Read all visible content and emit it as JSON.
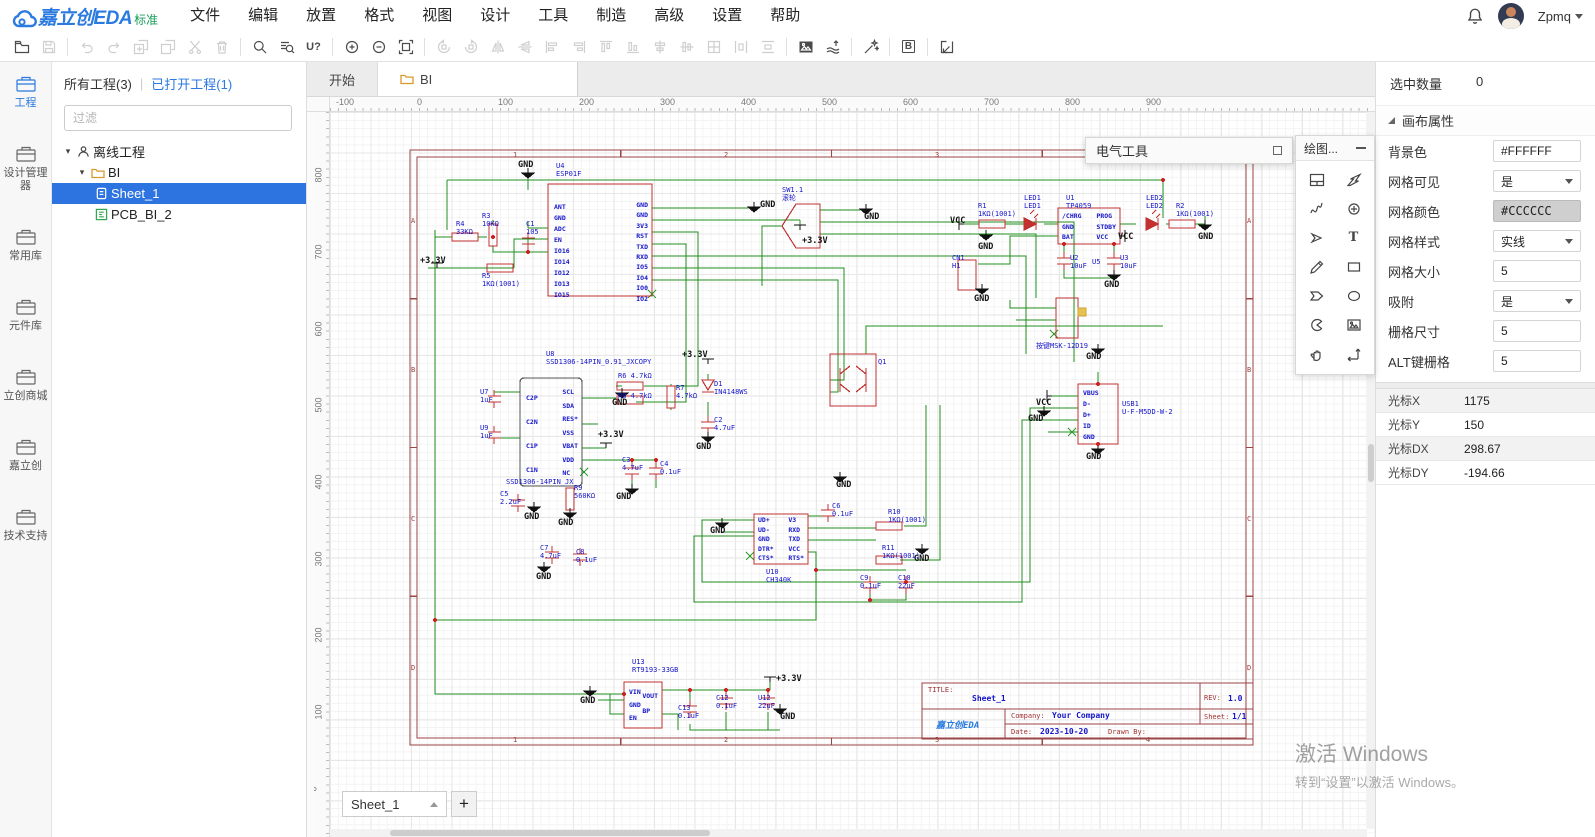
{
  "app": {
    "logo_text": "嘉立创EDA",
    "logo_badge": "标准",
    "user": "Zpmq"
  },
  "menubar": {
    "items": [
      "文件",
      "编辑",
      "放置",
      "格式",
      "视图",
      "设计",
      "工具",
      "制造",
      "高级",
      "设置",
      "帮助"
    ]
  },
  "toolbar": {
    "find_designator": "U?",
    "bom_letter": "B"
  },
  "rail": {
    "items": [
      {
        "label": "工程",
        "active": true
      },
      {
        "label": "设计管理器"
      },
      {
        "label": "常用库"
      },
      {
        "label": "元件库"
      },
      {
        "label": "立创商城"
      },
      {
        "label": "嘉立创"
      },
      {
        "label": "技术支持"
      }
    ]
  },
  "project_panel": {
    "tab_all": "所有工程(3)",
    "tab_divider": "|",
    "tab_open": "已打开工程(1)",
    "filter_placeholder": "过滤",
    "tree": {
      "root": "离线工程",
      "project": "BI",
      "sheet": "Sheet_1",
      "pcb": "PCB_BI_2"
    }
  },
  "doc_tabs": [
    {
      "label": "开始"
    },
    {
      "label": "BI",
      "active": true
    }
  ],
  "rulers": {
    "h": [
      {
        "t": "-100",
        "x": 6
      },
      {
        "t": "0",
        "x": 87
      },
      {
        "t": "100",
        "x": 168
      },
      {
        "t": "200",
        "x": 249
      },
      {
        "t": "300",
        "x": 330
      },
      {
        "t": "400",
        "x": 411
      },
      {
        "t": "500",
        "x": 492
      },
      {
        "t": "600",
        "x": 573
      },
      {
        "t": "700",
        "x": 654
      },
      {
        "t": "800",
        "x": 735
      },
      {
        "t": "900",
        "x": 816
      }
    ],
    "v": [
      {
        "t": "800",
        "y": 58
      },
      {
        "t": "700",
        "y": 135
      },
      {
        "t": "600",
        "y": 212
      },
      {
        "t": "500",
        "y": 288
      },
      {
        "t": "400",
        "y": 365
      },
      {
        "t": "300",
        "y": 442
      },
      {
        "t": "200",
        "y": 518
      },
      {
        "t": "100",
        "y": 595
      },
      {
        "t": "0",
        "y": 672
      }
    ]
  },
  "panels": {
    "electrical_title": "电气工具",
    "drawing_title": "绘图...",
    "drawing_text_tool": "T"
  },
  "sheet_bar": {
    "current": "Sheet_1",
    "add": "+"
  },
  "properties": {
    "selected_count_label": "选中数量",
    "selected_count": "0",
    "section_title": "画布属性",
    "rows": [
      {
        "label": "背景色",
        "value": "#FFFFFF",
        "type": "input"
      },
      {
        "label": "网格可见",
        "value": "是",
        "type": "select"
      },
      {
        "label": "网格颜色",
        "value": "#CCCCCC",
        "type": "color"
      },
      {
        "label": "网格样式",
        "value": "实线",
        "type": "select"
      },
      {
        "label": "网格大小",
        "value": "5",
        "type": "input"
      },
      {
        "label": "吸附",
        "value": "是",
        "type": "select"
      },
      {
        "label": "栅格尺寸",
        "value": "5",
        "type": "input"
      },
      {
        "label": "ALT键栅格",
        "value": "5",
        "type": "input"
      }
    ],
    "cursor_rows": [
      {
        "label": "光标X",
        "value": "1175"
      },
      {
        "label": "光标Y",
        "value": "150"
      },
      {
        "label": "光标DX",
        "value": "298.67"
      },
      {
        "label": "光标DY",
        "value": "-194.66"
      }
    ]
  },
  "watermark": {
    "line1": "激活 Windows",
    "line2": "转到“设置”以激活 Windows。"
  },
  "schematic": {
    "title_block": {
      "title_label": "TITLE:",
      "title": "Sheet_1",
      "rev_label": "REV:",
      "rev": "1.0",
      "company_label": "Company:",
      "company": "Your Company",
      "sheet_label": "Sheet:",
      "sheet": "1/1",
      "date_label": "Date:",
      "date": "2023-10-20",
      "drawn_label": "Drawn By:",
      "logo": "嘉立创EDA"
    },
    "labels": [
      {
        "t": "1",
        "x": 183,
        "y": 39,
        "c": "fr"
      },
      {
        "t": "2",
        "x": 394,
        "y": 39,
        "c": "fr"
      },
      {
        "t": "3",
        "x": 605,
        "y": 39,
        "c": "fr"
      },
      {
        "t": "4",
        "x": 816,
        "y": 39,
        "c": "fr"
      },
      {
        "t": "1",
        "x": 183,
        "y": 624,
        "c": "fr"
      },
      {
        "t": "2",
        "x": 394,
        "y": 624,
        "c": "fr"
      },
      {
        "t": "3",
        "x": 605,
        "y": 624,
        "c": "fr"
      },
      {
        "t": "4",
        "x": 816,
        "y": 624,
        "c": "fr"
      },
      {
        "t": "A",
        "x": 81,
        "y": 105,
        "c": "fr"
      },
      {
        "t": "B",
        "x": 81,
        "y": 254,
        "c": "fr"
      },
      {
        "t": "C",
        "x": 81,
        "y": 403,
        "c": "fr"
      },
      {
        "t": "D",
        "x": 81,
        "y": 552,
        "c": "fr"
      },
      {
        "t": "A",
        "x": 917,
        "y": 105,
        "c": "fr"
      },
      {
        "t": "B",
        "x": 917,
        "y": 254,
        "c": "fr"
      },
      {
        "t": "C",
        "x": 917,
        "y": 403,
        "c": "fr"
      },
      {
        "t": "D",
        "x": 917,
        "y": 552,
        "c": "fr"
      },
      {
        "t": "GND",
        "x": 188,
        "y": 48,
        "c": "k"
      },
      {
        "t": "GND",
        "x": 430,
        "y": 88,
        "c": "k"
      },
      {
        "t": "GND",
        "x": 534,
        "y": 100,
        "c": "k"
      },
      {
        "t": "GND",
        "x": 648,
        "y": 130,
        "c": "k"
      },
      {
        "t": "GND",
        "x": 774,
        "y": 168,
        "c": "k"
      },
      {
        "t": "GND",
        "x": 868,
        "y": 120,
        "c": "k"
      },
      {
        "t": "GND",
        "x": 644,
        "y": 182,
        "c": "k"
      },
      {
        "t": "GND",
        "x": 366,
        "y": 330,
        "c": "k"
      },
      {
        "t": "GND",
        "x": 282,
        "y": 286,
        "c": "k"
      },
      {
        "t": "GND",
        "x": 286,
        "y": 380,
        "c": "k"
      },
      {
        "t": "GND",
        "x": 194,
        "y": 400,
        "c": "k"
      },
      {
        "t": "GND",
        "x": 228,
        "y": 406,
        "c": "k"
      },
      {
        "t": "GND",
        "x": 206,
        "y": 460,
        "c": "k"
      },
      {
        "t": "GND",
        "x": 380,
        "y": 414,
        "c": "k"
      },
      {
        "t": "GND",
        "x": 506,
        "y": 368,
        "c": "k"
      },
      {
        "t": "GND",
        "x": 584,
        "y": 442,
        "c": "k"
      },
      {
        "t": "GND",
        "x": 250,
        "y": 584,
        "c": "k"
      },
      {
        "t": "GND",
        "x": 450,
        "y": 600,
        "c": "k"
      },
      {
        "t": "GND",
        "x": 756,
        "y": 240,
        "c": "k"
      },
      {
        "t": "GND",
        "x": 698,
        "y": 302,
        "c": "k"
      },
      {
        "t": "GND",
        "x": 756,
        "y": 340,
        "c": "k"
      },
      {
        "t": "VCC",
        "x": 620,
        "y": 104,
        "c": "k"
      },
      {
        "t": "VCC",
        "x": 788,
        "y": 120,
        "c": "k"
      },
      {
        "t": "VCC",
        "x": 706,
        "y": 286,
        "c": "k"
      },
      {
        "t": "+3.3V",
        "x": 90,
        "y": 144,
        "c": "k"
      },
      {
        "t": "+3.3V",
        "x": 472,
        "y": 124,
        "c": "k"
      },
      {
        "t": "+3.3V",
        "x": 352,
        "y": 238,
        "c": "k"
      },
      {
        "t": "+3.3V",
        "x": 268,
        "y": 318,
        "c": "k"
      },
      {
        "t": "+3.3V",
        "x": 446,
        "y": 562,
        "c": "k"
      },
      {
        "t": "U4\nESP01F",
        "x": 226,
        "y": 50,
        "c": "b"
      },
      {
        "t": "R4\n33KΩ",
        "x": 126,
        "y": 108,
        "c": "b"
      },
      {
        "t": "R3\n10KΩ",
        "x": 152,
        "y": 100,
        "c": "b"
      },
      {
        "t": "C1\n105",
        "x": 196,
        "y": 108,
        "c": "b"
      },
      {
        "t": "R5\n1KΩ(1001)",
        "x": 152,
        "y": 160,
        "c": "b"
      },
      {
        "t": "SW1.1\n滚轮",
        "x": 452,
        "y": 74,
        "c": "b"
      },
      {
        "t": "R1\n1KΩ(1001)",
        "x": 648,
        "y": 90,
        "c": "b"
      },
      {
        "t": "LED1\nLED1",
        "x": 694,
        "y": 82,
        "c": "b"
      },
      {
        "t": "U1\nTP4059",
        "x": 736,
        "y": 82,
        "c": "b"
      },
      {
        "t": "LED2\nLED2",
        "x": 816,
        "y": 82,
        "c": "b"
      },
      {
        "t": "R2\n1KΩ(1001)",
        "x": 846,
        "y": 90,
        "c": "b"
      },
      {
        "t": "U2\n10uF",
        "x": 740,
        "y": 142,
        "c": "b"
      },
      {
        "t": "U3\n10uF",
        "x": 790,
        "y": 142,
        "c": "b"
      },
      {
        "t": "U5",
        "x": 762,
        "y": 146,
        "c": "b"
      },
      {
        "t": "CN1\nH1",
        "x": 622,
        "y": 142,
        "c": "b"
      },
      {
        "t": "按键MSK-12D19",
        "x": 706,
        "y": 230,
        "c": "b"
      },
      {
        "t": "U8\nSSD1306-14PIN_0.91_JXCOPY",
        "x": 216,
        "y": 238,
        "c": "b"
      },
      {
        "t": "U7\n1uF",
        "x": 150,
        "y": 276,
        "c": "b"
      },
      {
        "t": "U9\n1uF",
        "x": 150,
        "y": 312,
        "c": "b"
      },
      {
        "t": "R6 4.7kΩ",
        "x": 288,
        "y": 260,
        "c": "b"
      },
      {
        "t": "R8 4.7kΩ",
        "x": 288,
        "y": 280,
        "c": "b"
      },
      {
        "t": "R7\n4.7kΩ",
        "x": 346,
        "y": 272,
        "c": "b"
      },
      {
        "t": "D1\nIN4148WS",
        "x": 384,
        "y": 268,
        "c": "b"
      },
      {
        "t": "C2\n4.7uF",
        "x": 384,
        "y": 304,
        "c": "b"
      },
      {
        "t": "C3\n4.7uF",
        "x": 292,
        "y": 344,
        "c": "b"
      },
      {
        "t": "C4\n0.1uF",
        "x": 330,
        "y": 348,
        "c": "b"
      },
      {
        "t": "SSD1306-14PIN_JX",
        "x": 176,
        "y": 366,
        "c": "b"
      },
      {
        "t": "C5\n2.2uF",
        "x": 170,
        "y": 378,
        "c": "b"
      },
      {
        "t": "R9\n560KΩ",
        "x": 244,
        "y": 372,
        "c": "b"
      },
      {
        "t": "C7\n4.7uF",
        "x": 210,
        "y": 432,
        "c": "b"
      },
      {
        "t": "C8\n0.1uF",
        "x": 246,
        "y": 436,
        "c": "b"
      },
      {
        "t": "Q1",
        "x": 548,
        "y": 246,
        "c": "b"
      },
      {
        "t": "USB1\nU-F-M5DD-W-2",
        "x": 792,
        "y": 288,
        "c": "b"
      },
      {
        "t": "U10\nCH340K",
        "x": 436,
        "y": 456,
        "c": "b"
      },
      {
        "t": "C6\n0.1uF",
        "x": 502,
        "y": 390,
        "c": "b"
      },
      {
        "t": "R10\n1KΩ(1001)",
        "x": 558,
        "y": 396,
        "c": "b"
      },
      {
        "t": "R11\n1KΩ(1001)",
        "x": 552,
        "y": 432,
        "c": "b"
      },
      {
        "t": "C9\n0.1uF",
        "x": 530,
        "y": 462,
        "c": "b"
      },
      {
        "t": "C10\n22uF",
        "x": 568,
        "y": 462,
        "c": "b"
      },
      {
        "t": "U13\nRT9193-33GB",
        "x": 302,
        "y": 546,
        "c": "b"
      },
      {
        "t": "C13\n0.1uF",
        "x": 348,
        "y": 592,
        "c": "b"
      },
      {
        "t": "C12\n0.1uF",
        "x": 386,
        "y": 582,
        "c": "b"
      },
      {
        "t": "U12\n22uF",
        "x": 428,
        "y": 582,
        "c": "b"
      },
      {
        "t": "ANT\nGND\nADC\nEN\nIO16\nIO14\nIO12\nIO13\nIO15",
        "x": 224,
        "y": 90,
        "c": "bp",
        "lh": 11
      },
      {
        "t": "GND\nGND\n3V3\nRST\nTXD\nRXD\nIO5\nIO4\nIO0\nIO2",
        "x": 318,
        "y": 88,
        "c": "bp",
        "lh": 10.4,
        "a": "r"
      },
      {
        "t": "C2P\nC2N\nC1P\nC1N",
        "x": 196,
        "y": 274,
        "c": "bp",
        "lh": 24
      },
      {
        "t": "SCL\nSDA\nRES*\nVSS\nVBAT\nVDD\nNC",
        "x": 248,
        "y": 274,
        "c": "bp",
        "lh": 13.5,
        "a": "r"
      },
      {
        "t": "UD+\nUD-\nGND\nDTR*\nCTS*",
        "x": 428,
        "y": 404,
        "c": "bp",
        "lh": 9.5
      },
      {
        "t": "V3\nRXD\nTXD\nVCC\nRTS*",
        "x": 474,
        "y": 404,
        "c": "bp",
        "lh": 9.5,
        "a": "r"
      },
      {
        "t": "VIN\nGND\nEN",
        "x": 299,
        "y": 574,
        "c": "bp",
        "lh": 13
      },
      {
        "t": "VOUT\nBP",
        "x": 328,
        "y": 577,
        "c": "bp",
        "lh": 15,
        "a": "r"
      },
      {
        "t": "/CHRG\nGND\nBAT",
        "x": 732,
        "y": 99,
        "c": "bp",
        "lh": 10.5
      },
      {
        "t": "PROG\nSTDBY\nVCC",
        "x": 786,
        "y": 99,
        "c": "bp",
        "lh": 10.5,
        "a": "r"
      },
      {
        "t": "VBUS\nD-\nD+\nID\nGND",
        "x": 753,
        "y": 276,
        "c": "bp",
        "lh": 11
      }
    ]
  }
}
